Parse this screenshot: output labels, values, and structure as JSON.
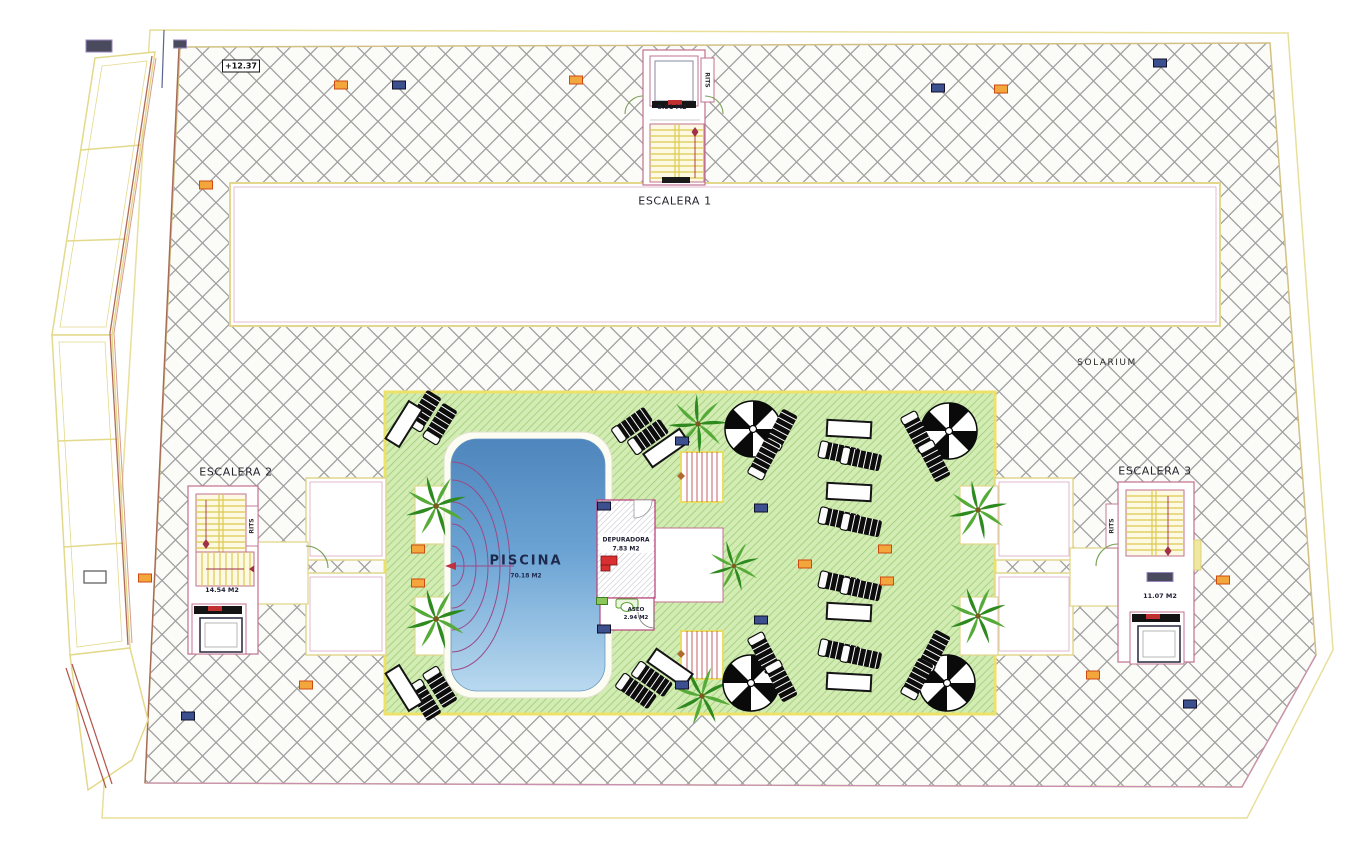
{
  "labels": {
    "escalera1": "ESCALERA 1",
    "escalera1_area": "8.91 M2",
    "escalera2": "ESCALERA 2",
    "escalera2_area": "14.54 M2",
    "escalera3": "ESCALERA 3",
    "escalera3_area": "11.07 M2",
    "solarium": "SOLARIUM",
    "piscina": "PISCINA",
    "piscina_area": "70.18 M2",
    "depuradora": "DEPURADORA",
    "depuradora_area": "7.83 M2",
    "aseo": "ASEO",
    "aseo_area": "2.94 M2",
    "rits": "RITS",
    "elevation": "+12.37"
  },
  "colors": {
    "hatch_line": "#a0a0a0",
    "boundary_yellow": "#e2d78d",
    "room_outline_pink": "#c07090",
    "green_fill": "#d2ecb4",
    "green_line": "#9bcb71",
    "pool_top": "#4e86bd",
    "pool_bottom": "#b9d9ef",
    "stair_yellow": "#dcc94f",
    "red_accent": "#c03040",
    "marker_orange": "#f2a63c",
    "marker_blue": "#3c4f8f"
  },
  "furniture": {
    "palms": [
      [
        436,
        506,
        0,
        1.15
      ],
      [
        436,
        619,
        0,
        1.15
      ],
      [
        698,
        424,
        15,
        1.1
      ],
      [
        702,
        696,
        -10,
        1.1
      ],
      [
        734,
        566,
        0,
        0.95
      ],
      [
        978,
        510,
        5,
        1.1
      ],
      [
        978,
        616,
        -5,
        1.1
      ]
    ],
    "parasols": [
      [
        753,
        429
      ],
      [
        949,
        431
      ],
      [
        751,
        683
      ],
      [
        947,
        683
      ]
    ],
    "loungers": [
      [
        424,
        411,
        -58
      ],
      [
        440,
        424,
        -58
      ],
      [
        424,
        700,
        58
      ],
      [
        440,
        687,
        58
      ],
      [
        632,
        425,
        -35
      ],
      [
        648,
        437,
        -35
      ],
      [
        636,
        691,
        35
      ],
      [
        652,
        679,
        35
      ],
      [
        781,
        430,
        -62
      ],
      [
        764,
        459,
        -62
      ],
      [
        917,
        432,
        62
      ],
      [
        934,
        461,
        62
      ],
      [
        764,
        653,
        62
      ],
      [
        781,
        681,
        62
      ],
      [
        934,
        651,
        -62
      ],
      [
        917,
        679,
        -62
      ],
      [
        839,
        453,
        12
      ],
      [
        861,
        459,
        12
      ],
      [
        839,
        519,
        12
      ],
      [
        861,
        525,
        12
      ],
      [
        839,
        583,
        12
      ],
      [
        861,
        589,
        12
      ],
      [
        839,
        651,
        12
      ],
      [
        861,
        657,
        12
      ]
    ],
    "tables": [
      [
        404,
        424,
        -58
      ],
      [
        404,
        688,
        58
      ],
      [
        666,
        448,
        -35
      ],
      [
        670,
        668,
        35
      ],
      [
        849,
        429,
        3
      ],
      [
        849,
        492,
        3
      ],
      [
        849,
        612,
        3
      ],
      [
        849,
        682,
        3
      ]
    ]
  },
  "markers": [
    {
      "t": "orange",
      "x": 341,
      "y": 85
    },
    {
      "t": "orange",
      "x": 576,
      "y": 80
    },
    {
      "t": "orange",
      "x": 1001,
      "y": 89
    },
    {
      "t": "orange",
      "x": 206,
      "y": 185
    },
    {
      "t": "orange",
      "x": 306,
      "y": 685
    },
    {
      "t": "orange",
      "x": 1093,
      "y": 675
    },
    {
      "t": "orange",
      "x": 1223,
      "y": 580
    },
    {
      "t": "orange",
      "x": 418,
      "y": 549
    },
    {
      "t": "orange",
      "x": 418,
      "y": 583
    },
    {
      "t": "orange",
      "x": 805,
      "y": 564
    },
    {
      "t": "orange",
      "x": 885,
      "y": 549
    },
    {
      "t": "orange",
      "x": 887,
      "y": 581
    },
    {
      "t": "orange",
      "x": 145,
      "y": 578
    },
    {
      "t": "blue",
      "x": 399,
      "y": 85
    },
    {
      "t": "blue",
      "x": 938,
      "y": 88
    },
    {
      "t": "blue",
      "x": 1160,
      "y": 63
    },
    {
      "t": "blue",
      "x": 188,
      "y": 716
    },
    {
      "t": "blue",
      "x": 1190,
      "y": 704
    },
    {
      "t": "blue",
      "x": 761,
      "y": 508
    },
    {
      "t": "blue",
      "x": 761,
      "y": 620
    },
    {
      "t": "blue",
      "x": 604,
      "y": 506
    },
    {
      "t": "blue",
      "x": 604,
      "y": 629
    },
    {
      "t": "blue",
      "x": 682,
      "y": 441
    },
    {
      "t": "blue",
      "x": 682,
      "y": 685
    },
    {
      "t": "dark",
      "x": 180,
      "y": 44
    },
    {
      "t": "dark",
      "x": 1160,
      "y": 577,
      "w": 26,
      "h": 9
    },
    {
      "t": "dark",
      "x": 99,
      "y": 46,
      "w": 26,
      "h": 12
    },
    {
      "t": "outline",
      "x": 95,
      "y": 577,
      "w": 22,
      "h": 12
    },
    {
      "t": "green",
      "x": 602,
      "y": 601,
      "w": 11,
      "h": 7
    }
  ]
}
